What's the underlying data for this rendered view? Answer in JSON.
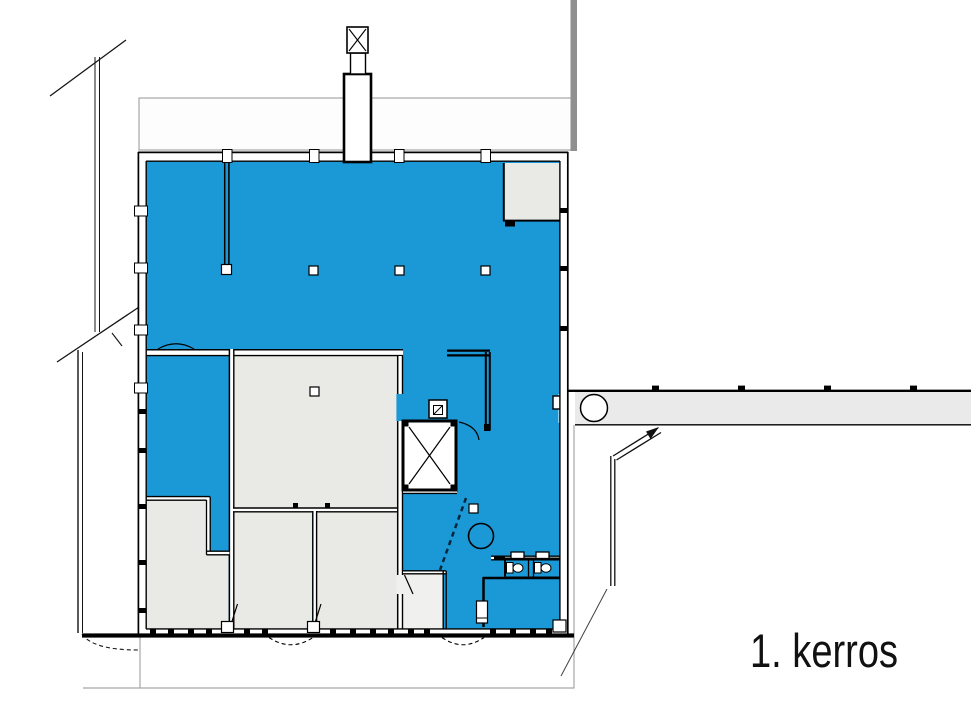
{
  "label": {
    "text": "1. kerros"
  },
  "colors": {
    "background": "#FFFFFF",
    "highlight": "#1B98D6",
    "room": "#E9E9E6",
    "roomlight": "#F0F0EE",
    "corridor": "#EAEAEA",
    "wall": "#000000",
    "site": "#8F8F8F",
    "siteline": "#A6A6A6"
  }
}
